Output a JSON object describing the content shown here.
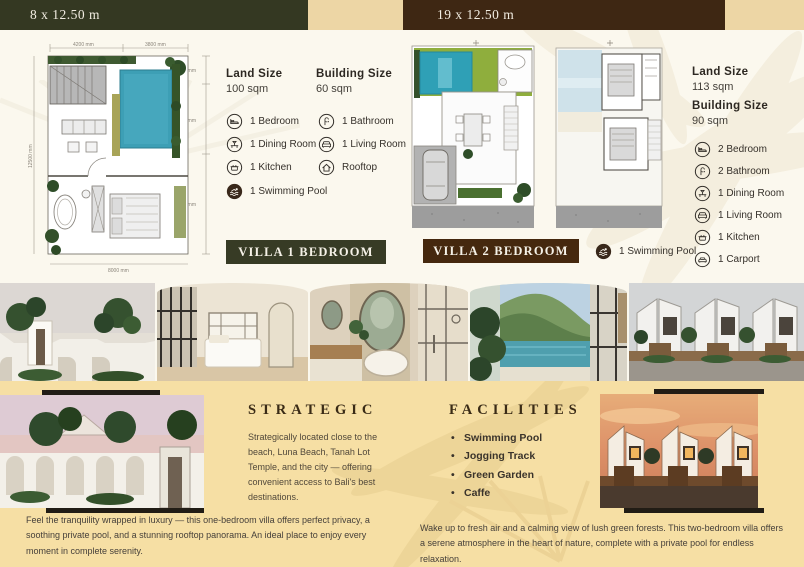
{
  "header": {
    "left_ribbon": "8 x 12.50 m",
    "right_ribbon": "19 x 12.50 m"
  },
  "villa1": {
    "name": "VILLA 1 BEDROOM",
    "land_size": {
      "label": "Land Size",
      "value": "100 sqm"
    },
    "building_size": {
      "label": "Building Size",
      "value": "60 sqm"
    },
    "features_left": [
      {
        "icon": "bed-icon",
        "label": "1 Bedroom"
      },
      {
        "icon": "dining-icon",
        "label": "1 Dining Room"
      },
      {
        "icon": "kitchen-icon",
        "label": "1 Kitchen"
      }
    ],
    "features_right": [
      {
        "icon": "bathroom-icon",
        "label": "1 Bathroom"
      },
      {
        "icon": "living-room-icon",
        "label": "1 Living Room"
      },
      {
        "icon": "rooftop-icon",
        "label": "Rooftop"
      }
    ],
    "pool": {
      "icon": "swimming-pool-icon",
      "label": "1 Swimming Pool"
    },
    "plan_dimensions": {
      "top1": "4200 mm",
      "top2": "3800 mm",
      "right1": "1500 mm",
      "right2": "4500 mm",
      "right3": "6500 mm",
      "bottom": "8000 mm",
      "left": "12500 mm"
    }
  },
  "villa2": {
    "name": "VILLA 2 BEDROOM",
    "pool": {
      "icon": "swimming-pool-icon",
      "label": "1 Swimming Pool"
    },
    "land_size": {
      "label": "Land Size",
      "value": "113 sqm"
    },
    "building_size": {
      "label": "Building Size",
      "value": "90 sqm"
    },
    "features": [
      {
        "icon": "bed-icon",
        "label": "2 Bedroom"
      },
      {
        "icon": "bathroom-icon",
        "label": "2 Bathroom"
      },
      {
        "icon": "dining-icon",
        "label": "1 Dining Room"
      },
      {
        "icon": "living-room-icon",
        "label": "1 Living Room"
      },
      {
        "icon": "kitchen-icon",
        "label": "1 Kitchen"
      },
      {
        "icon": "carport-icon",
        "label": "1 Carport"
      }
    ]
  },
  "strategic": {
    "heading": "STRATEGIC",
    "body": "Strategically located close to the beach, Luna Beach, Tanah Lot Temple, and the city — offering convenient access to Bali's best destinations."
  },
  "facilities": {
    "heading": "FACILITIES",
    "items": [
      "Swimming Pool",
      "Jogging Track",
      "Green Garden",
      "Caffe"
    ]
  },
  "captions": {
    "villa1": "Feel the tranquility wrapped in luxury — this one-bedroom villa offers perfect privacy, a soothing private pool, and a stunning rooftop panorama. An ideal place to enjoy every moment in complete serenity.",
    "villa2": "Wake up to fresh air and a calming view of lush green forests. This two-bedroom villa offers a serene atmosphere in the heart of nature, complete with a private pool for endless relaxation."
  },
  "icons": {
    "bed-icon": "bed outline in circle",
    "bathroom-icon": "shower outline in circle",
    "dining-icon": "dining table outline in circle",
    "living-room-icon": "sofa outline in circle",
    "kitchen-icon": "stove pot outline in circle",
    "rooftop-icon": "house roof outline in circle",
    "carport-icon": "car outline in circle",
    "swimming-pool-icon": "white swimmer on dark filled circle"
  },
  "photos": [
    "villa-entrance-palms",
    "bedroom-interior",
    "bathroom-oval-mirror",
    "pool-jungle-view",
    "villa-row-facade",
    "white-arched-villa-sunset",
    "villa-row-golden-sunset"
  ],
  "colors": {
    "olive_bar": "#343822",
    "brown_bar": "#3e2713",
    "beige_block": "#edd6a5",
    "cream_bg": "#fbf8ee",
    "sand_bg": "#f6dfa4",
    "villa1_button": "#373b25",
    "villa2_button": "#45280e",
    "pool_blue": "#3d9fb5",
    "lawn_green": "#8fae3d",
    "text_dark": "#35302a"
  }
}
